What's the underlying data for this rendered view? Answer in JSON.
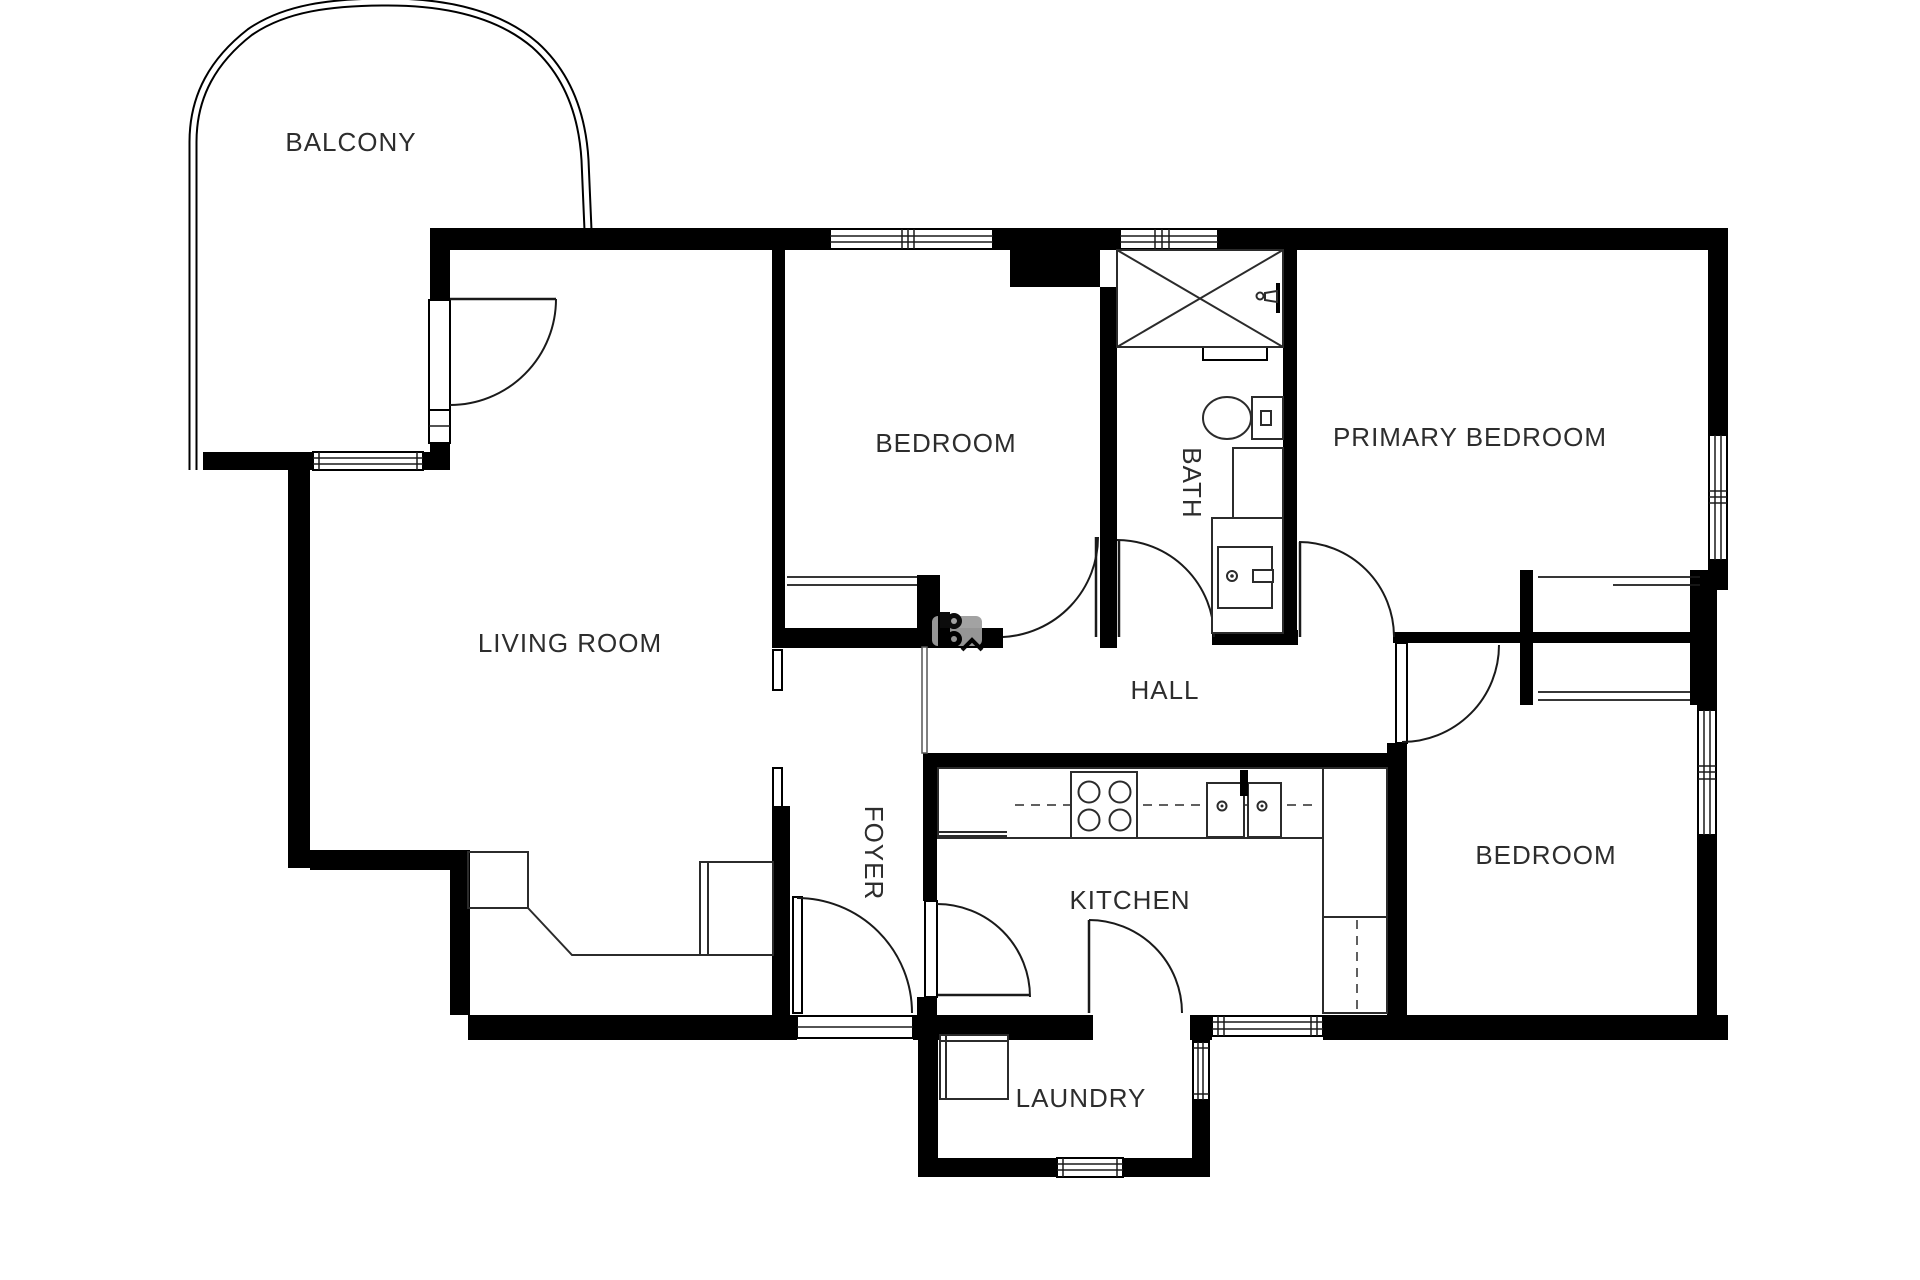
{
  "plan": {
    "type": "apartment-floor-plan",
    "colors": {
      "wall": "#000000",
      "fixture_line": "#2b2b2b",
      "label_text": "#2d2d2d",
      "watermark_gray": "#9e9e9e",
      "background": "#ffffff"
    },
    "rooms": {
      "balcony": {
        "label": "BALCONY"
      },
      "living_room": {
        "label": "LIVING ROOM"
      },
      "bedroom1": {
        "label": "BEDROOM"
      },
      "bath": {
        "label": "BATH"
      },
      "primary_bedroom": {
        "label": "PRIMARY BEDROOM"
      },
      "hall": {
        "label": "HALL"
      },
      "foyer": {
        "label": "FOYER"
      },
      "kitchen": {
        "label": "KITCHEN"
      },
      "bedroom2": {
        "label": "BEDROOM"
      },
      "laundry": {
        "label": "LAUNDRY"
      }
    }
  }
}
